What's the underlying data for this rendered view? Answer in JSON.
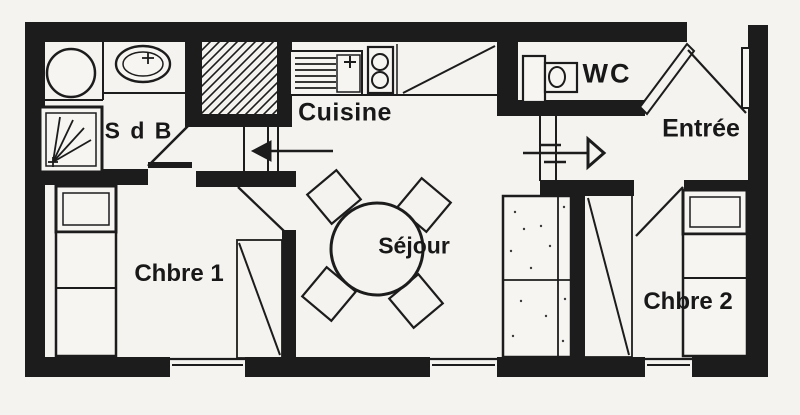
{
  "colors": {
    "ink": "#1c1c1c",
    "paper": "#f4f3f0",
    "fixture_fill": "#f6f5f2"
  },
  "plan": {
    "type": "apartment-floor-plan",
    "rooms": {
      "sdb": {
        "label": "S d B"
      },
      "cuisine": {
        "label": "Cuisine"
      },
      "wc": {
        "label": "WC"
      },
      "entree": {
        "label": "Entrée"
      },
      "sejour": {
        "label": "Séjour"
      },
      "chbre1": {
        "label": "Chbre 1"
      },
      "chbre2": {
        "label": "Chbre 2"
      }
    },
    "fixtures": [
      "washing-machine",
      "washbasin",
      "shower",
      "hatched-closet",
      "kitchen-sink-with-drainer",
      "cooktop-2-burners",
      "counter",
      "toilet",
      "entry-door",
      "direction-arrow-right",
      "direction-arrow-left",
      "round-dining-table",
      "four-chairs",
      "wardrobe",
      "single-bed-chbre1",
      "single-bed-chbre2",
      "window-chbre1",
      "window-sejour",
      "window-chbre2"
    ]
  }
}
